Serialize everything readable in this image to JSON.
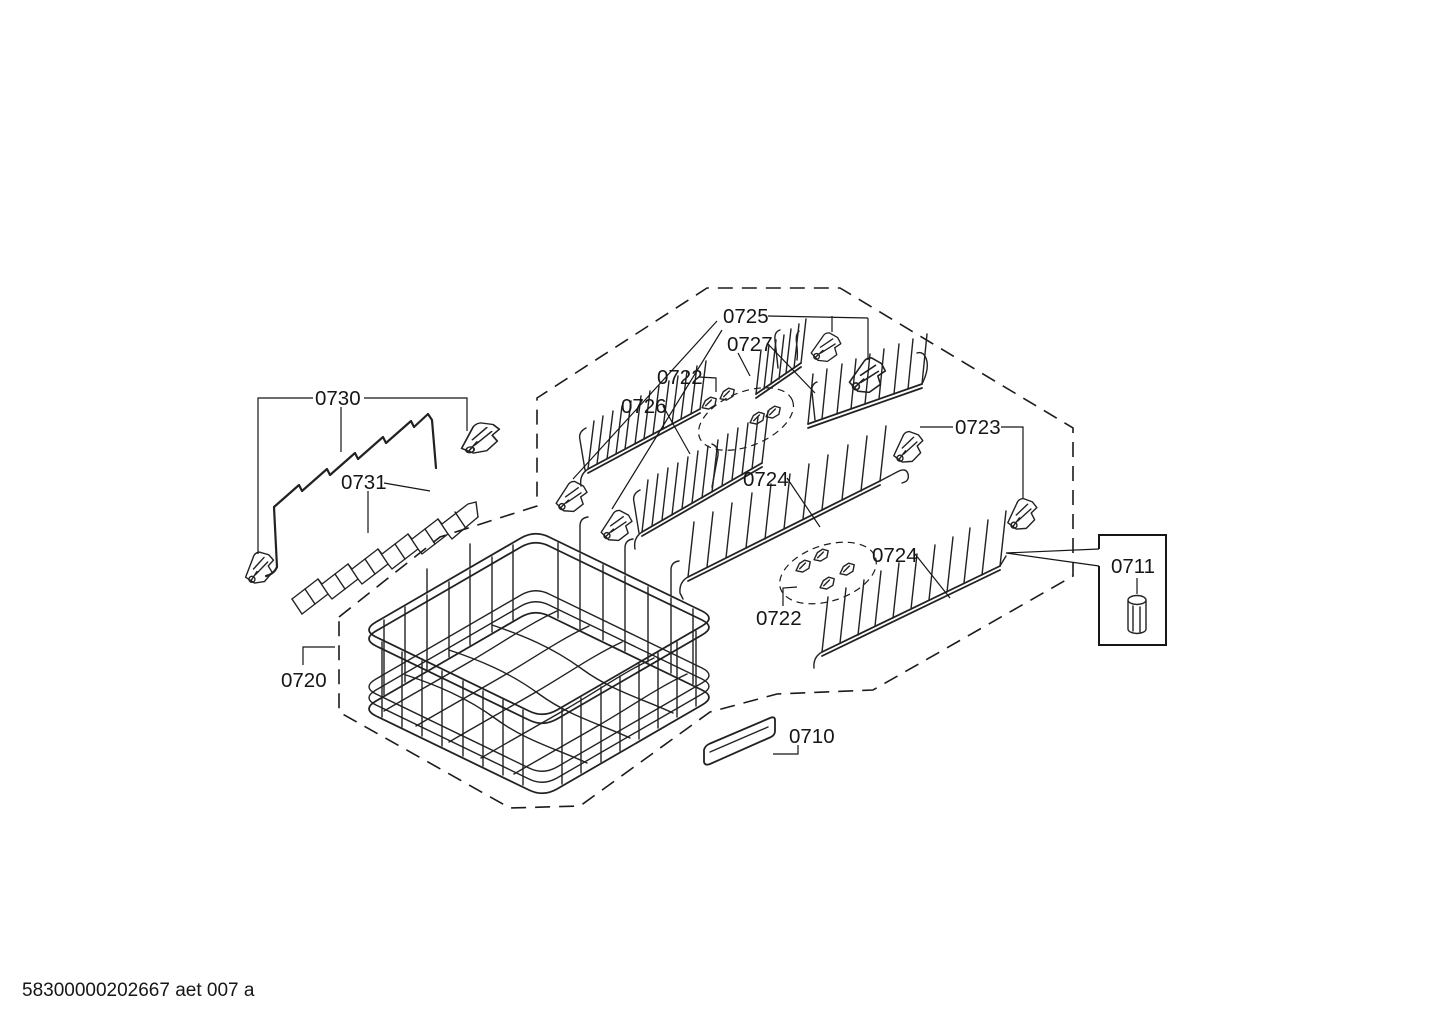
{
  "diagram": {
    "type": "exploded-parts-diagram",
    "colors": {
      "background": "#ffffff",
      "line": "#1b1b1b"
    },
    "parts_visible": [
      "0710",
      "0711",
      "0720",
      "0722",
      "0723",
      "0724",
      "0725",
      "0726",
      "0727",
      "0730",
      "0731"
    ],
    "labels": [
      {
        "part": "0725",
        "text": "0725"
      },
      {
        "part": "0727",
        "text": "0727"
      },
      {
        "part": "0722",
        "text": "0722"
      },
      {
        "part": "0726",
        "text": "0726"
      },
      {
        "part": "0724",
        "text": "0724"
      },
      {
        "part": "0724",
        "text": "0724"
      },
      {
        "part": "0722",
        "text": "0722"
      },
      {
        "part": "0723",
        "text": "0723"
      },
      {
        "part": "0730",
        "text": "0730"
      },
      {
        "part": "0731",
        "text": "0731"
      },
      {
        "part": "0720",
        "text": "0720"
      },
      {
        "part": "0711",
        "text": "0711"
      },
      {
        "part": "0710",
        "text": "0710"
      }
    ],
    "footer": {
      "text": "58300000202667 aet 007 a"
    }
  }
}
